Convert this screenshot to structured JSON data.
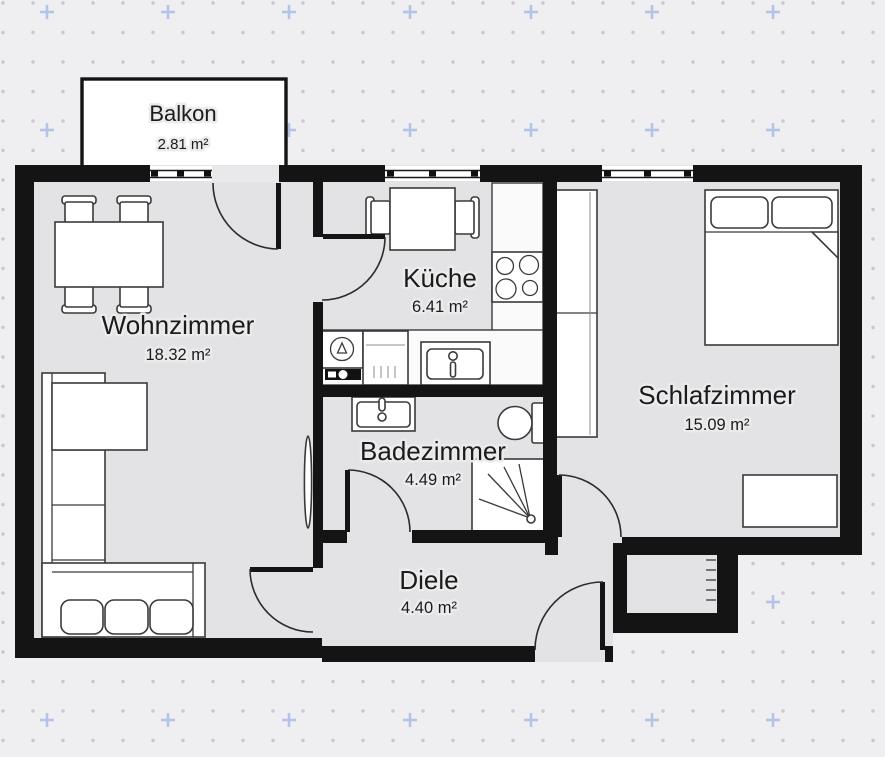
{
  "meta": {
    "type": "floor-plan",
    "language": "de",
    "style": "2d-black-white-architectural"
  },
  "canvas": {
    "width": 885,
    "height": 757,
    "background_color": "#efeff1",
    "floor_color": "#e3e3e5",
    "wall_color": "#141414",
    "dot_grid_color": "#c7c7cd",
    "plus_grid_color": "#b3c4e6",
    "label_color": "#1b1b1d"
  },
  "rooms": {
    "balkon": {
      "name": "Balkon",
      "area": "2.81 m²"
    },
    "wohnzimmer": {
      "name": "Wohnzimmer",
      "area": "18.32 m²"
    },
    "kueche": {
      "name": "Küche",
      "area": "6.41 m²"
    },
    "schlafzimmer": {
      "name": "Schlafzimmer",
      "area": "15.09 m²"
    },
    "badezimmer": {
      "name": "Badezimmer",
      "area": "4.49 m²"
    },
    "diele": {
      "name": "Diele",
      "area": "4.40 m²"
    }
  },
  "furniture_icons": [
    "dining-table",
    "dining-chair",
    "corner-sofa",
    "radiator",
    "kitchen-table",
    "kitchen-chair",
    "stove-hob",
    "kitchen-counter",
    "washing-machine",
    "dishwasher",
    "kitchen-sink",
    "bathroom-sink",
    "toilet",
    "shower",
    "wardrobe",
    "double-bed",
    "dresser",
    "duct-shaft"
  ],
  "openings": [
    "balcony-window",
    "balcony-door",
    "kitchen-window",
    "bedroom-window",
    "kitchen-door",
    "living-room-door",
    "bathroom-door",
    "bedroom-door",
    "entrance-door"
  ]
}
